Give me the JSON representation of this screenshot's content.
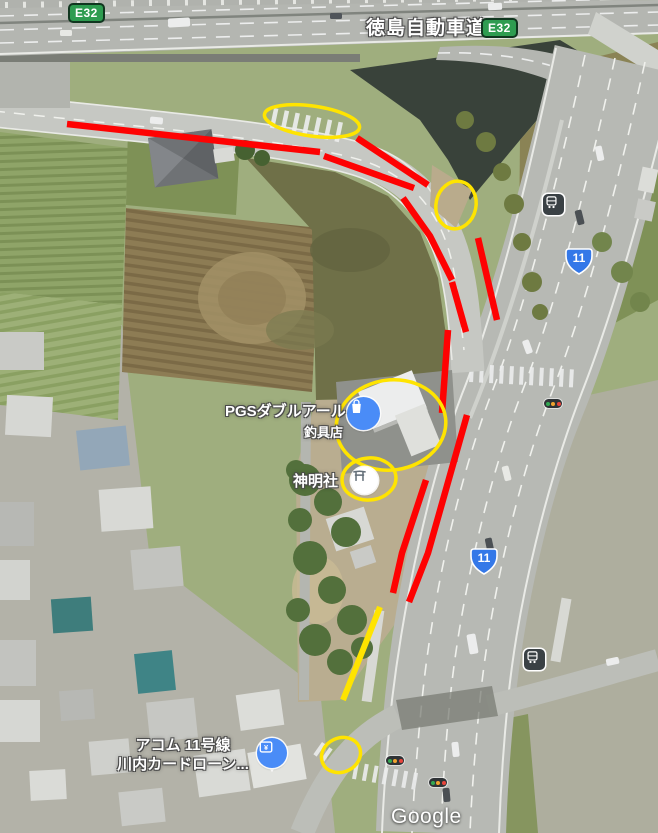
{
  "map": {
    "watermark": "Google",
    "expressway": {
      "name": "徳島自動車道",
      "shield": "E32"
    },
    "route_shields": [
      {
        "number": "11"
      },
      {
        "number": "11"
      }
    ],
    "pois": [
      {
        "id": "pgs-tackle-shop",
        "name_line1": "PGSダブルアール",
        "name_line2": "釣具店",
        "icon": "shopping-bag-icon",
        "color": "#4a8cf7"
      },
      {
        "id": "shinmeisha-shrine",
        "name": "神明社",
        "icon": "torii-icon",
        "color": "#ffffff"
      },
      {
        "id": "acom-loan-branch",
        "name_line1": "アコム 11号線",
        "name_line2": "川内カードローン...",
        "icon": "finance-pin-icon",
        "color": "#4a8cf7"
      }
    ],
    "transit": [
      {
        "type": "bus-stop"
      },
      {
        "type": "bus-stop"
      }
    ],
    "traffic_signal_count": 3
  },
  "annotations": {
    "colors": {
      "red": "#fe0202",
      "yellow": "#ffe400"
    },
    "red_line_count": 9,
    "yellow_line_count": 1,
    "yellow_ellipse_count": 5
  },
  "theme": {
    "expressway_shield_green": "#2e9c50",
    "route_shield_blue": "#3478e8",
    "poi_blue": "#4a8cf7",
    "traffic_light_colors": [
      "#33a852",
      "#f0a32f",
      "#e8453c"
    ]
  }
}
